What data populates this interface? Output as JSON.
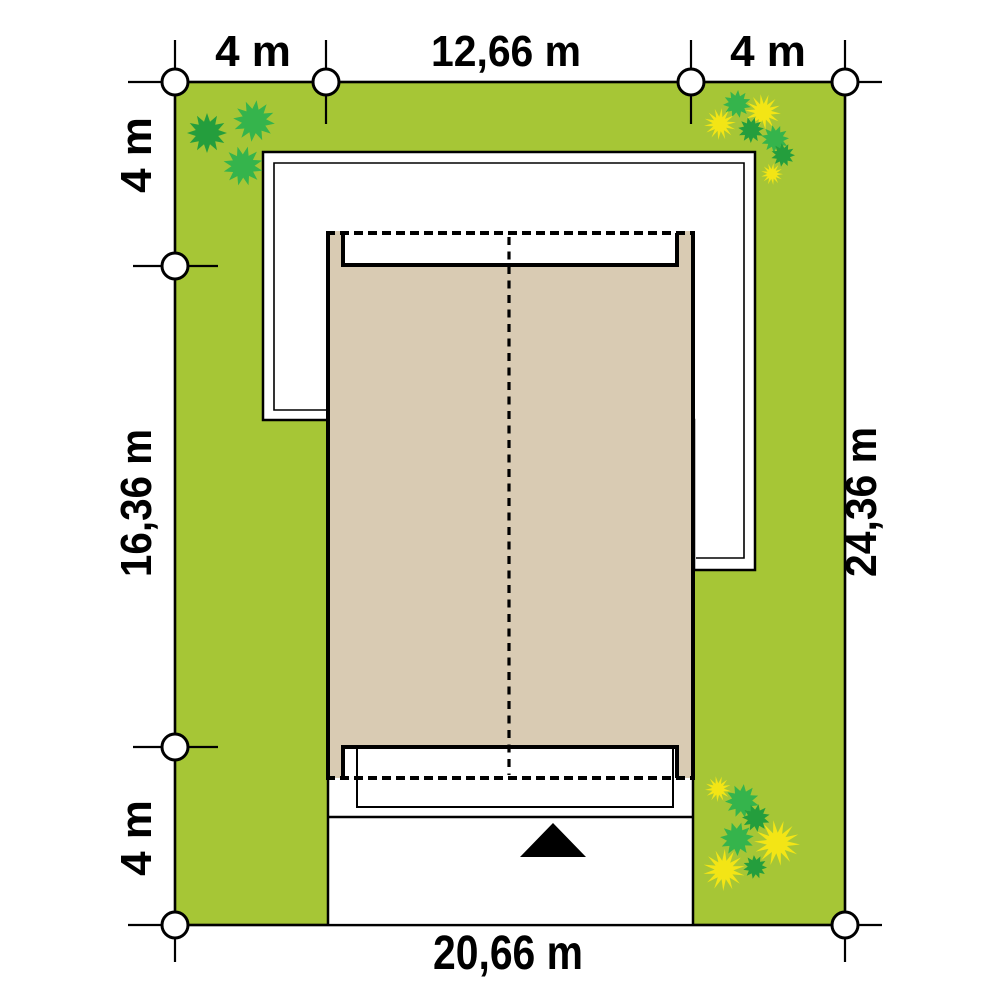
{
  "diagram": {
    "type": "site-plan",
    "dimensions": {
      "top_left_setback": "4 m",
      "top_house_width": "12,66 m",
      "top_right_setback": "4 m",
      "left_top_setback": "4 m",
      "left_house_depth": "16,36 m",
      "left_bottom_setback": "4 m",
      "right_plot_depth": "24,36 m",
      "bottom_plot_width": "20,66 m"
    }
  },
  "colors": {
    "plot_green": "#a6c636",
    "building_tan": "#d9cbb3",
    "roof_white": "#ffffff",
    "outline_black": "#000000",
    "bush_green": "#35b44c",
    "bush_green_dark": "#249e3d",
    "flower_yellow": "#f3e515"
  }
}
